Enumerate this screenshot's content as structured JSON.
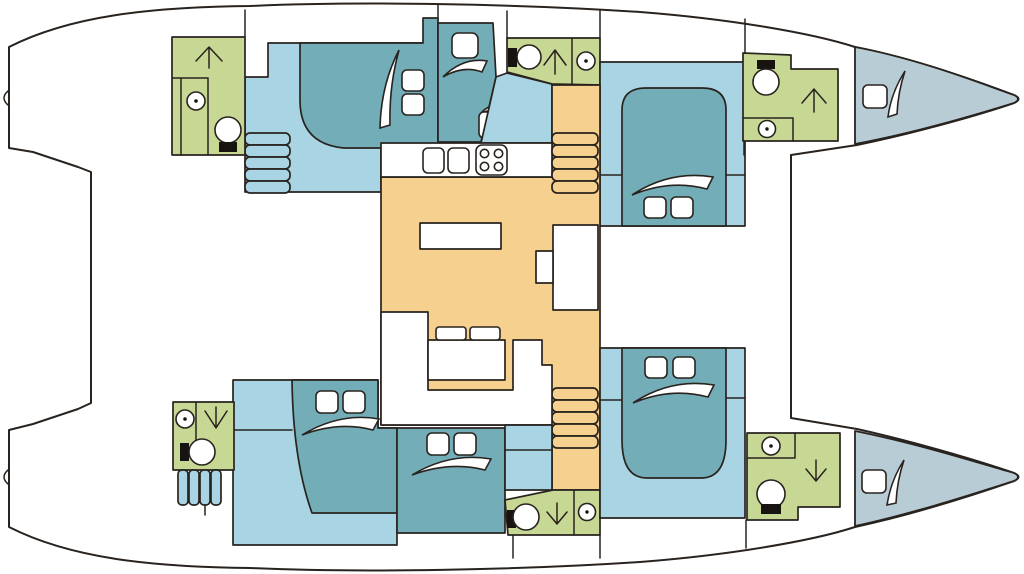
{
  "document_title": "Catamaran deck plan",
  "canvas": {
    "width": 1024,
    "height": 574
  },
  "colors": {
    "hull_white": "#ffffff",
    "outline": "#29231f",
    "cabin_pale": "#a9d4e3",
    "bed_teal": "#73adb7",
    "head_green": "#c7d794",
    "salon_orange": "#f5d08e",
    "bow_gray": "#b8ccd5",
    "fixture_black": "#161310"
  },
  "legend": {
    "cabin_pale": "cabin floor",
    "bed_teal": "berth / bed",
    "head_green": "bathroom (head)",
    "salon_orange": "salon and galley",
    "bow_gray": "bow locker",
    "hull_white": "deck"
  },
  "rooms": [
    {
      "id": "port-aft-head",
      "type": "bathroom"
    },
    {
      "id": "port-aft-cabin",
      "type": "double cabin"
    },
    {
      "id": "port-mid-berth",
      "type": "single berth"
    },
    {
      "id": "port-fwd-cabin",
      "type": "double cabin"
    },
    {
      "id": "port-fwd-head",
      "type": "bathroom"
    },
    {
      "id": "port-bow-locker",
      "type": "storage"
    },
    {
      "id": "salon-galley",
      "type": "galley and salon"
    },
    {
      "id": "nav-station",
      "type": "chart table"
    },
    {
      "id": "stbd-aft-head",
      "type": "bathroom"
    },
    {
      "id": "stbd-aft-cabin",
      "type": "double cabin"
    },
    {
      "id": "stbd-mid-berth",
      "type": "double berth"
    },
    {
      "id": "stbd-fwd-cabin",
      "type": "double cabin"
    },
    {
      "id": "stbd-fwd-head",
      "type": "bathroom"
    },
    {
      "id": "stbd-bow-locker",
      "type": "storage"
    }
  ],
  "icons": [
    "toilet-icon",
    "sink-icon",
    "stairs-arrow-up-icon",
    "stairs-arrow-down-icon",
    "stove-icon",
    "hatch-icon",
    "pillow",
    "bed-cover-swoosh",
    "steps"
  ]
}
